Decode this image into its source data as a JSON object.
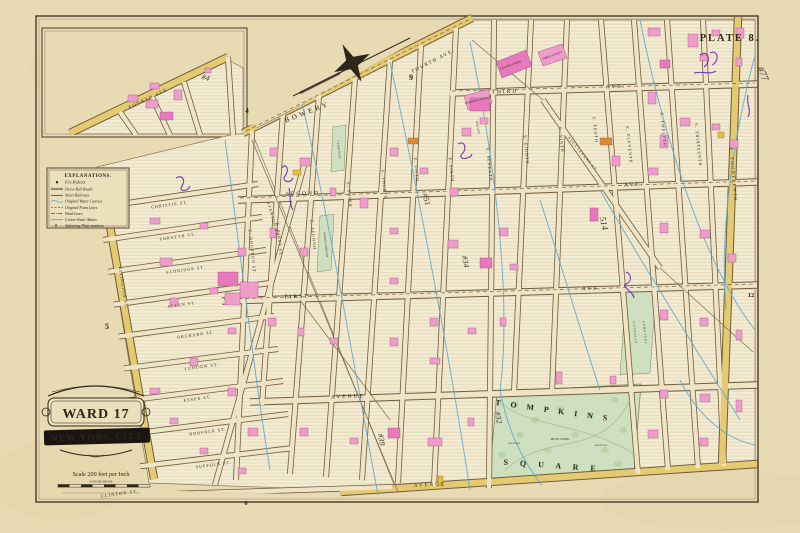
{
  "plate": {
    "title": "PLATE 8.",
    "ward_line1": "WARD 17",
    "ward_line2": "NEW YORK CITY",
    "scale_text": "Scale 200 feet per Inch",
    "scale_ticks": "0      100       200       300       400"
  },
  "explanations": {
    "title": "EXPLANATIONS.",
    "plate_number_symbol": "9",
    "items": [
      "Fire Hydrant",
      "Horse Rail Roads",
      "Street Railways",
      "Original Water Courses",
      "Original Farm Lines",
      "Ward Lines",
      "Croton Water Mains",
      "Adjoining Plate numbers"
    ]
  },
  "colors": {
    "paper": "#e8dab3",
    "cream": "#efe4c5",
    "block": "#f3ebd2",
    "yellow": "#e5ca72",
    "pink": "#f09ccb",
    "deeppink": "#e878bc",
    "bright_yellow": "#e2c235",
    "orange": "#dd8a2e",
    "green": "#cfe0c0",
    "blue": "#5ba6d2",
    "purple": "#6a28b0",
    "ink": "#2f2619",
    "border": "#463828"
  },
  "labels": [
    {
      "n": "street-bowery",
      "t": "BOWERY",
      "x": 308,
      "y": 114,
      "r": -21,
      "s": 7,
      "ls": 3
    },
    {
      "n": "street-fourth-ave",
      "t": "FOURTH AVE.",
      "x": 434,
      "y": 62,
      "r": -27,
      "s": 5,
      "ls": 1.5
    },
    {
      "n": "street-third-ave",
      "t": "THIRD",
      "x": 505,
      "y": 93,
      "r": -2,
      "s": 5.5,
      "ls": 2
    },
    {
      "n": "street-third-ave-2",
      "t": "AVE.",
      "x": 616,
      "y": 88,
      "r": -2,
      "s": 5.5,
      "ls": 2
    },
    {
      "n": "street-second-ave",
      "t": "SECOND",
      "x": 303,
      "y": 195,
      "r": -2,
      "s": 5.5,
      "ls": 2
    },
    {
      "n": "street-second-ave-2",
      "t": "AVE.",
      "x": 634,
      "y": 186,
      "r": -2,
      "s": 5.5,
      "ls": 2
    },
    {
      "n": "street-first-ave",
      "t": "FIRST",
      "x": 297,
      "y": 298,
      "r": -2,
      "s": 5.5,
      "ls": 2
    },
    {
      "n": "street-first-ave-2",
      "t": "AVE.",
      "x": 592,
      "y": 290,
      "r": -2,
      "s": 5.5,
      "ls": 2
    },
    {
      "n": "street-avenue-a",
      "t": "AVENUE",
      "x": 348,
      "y": 398,
      "r": -2,
      "s": 5.5,
      "ls": 2
    },
    {
      "n": "street-avenue-b",
      "t": "AVENUE",
      "x": 430,
      "y": 486,
      "r": -3,
      "s": 5,
      "ls": 2
    },
    {
      "n": "street-clinton",
      "t": "CLINTON ST.",
      "x": 120,
      "y": 495,
      "r": -8,
      "s": 4.5,
      "ls": 1
    },
    {
      "n": "street-christie",
      "t": "CHRISTIE ST.",
      "x": 170,
      "y": 206,
      "r": -8,
      "s": 4.2,
      "ls": 1
    },
    {
      "n": "street-forsyth",
      "t": "FORSYTH ST.",
      "x": 178,
      "y": 238,
      "r": -8,
      "s": 4.2,
      "ls": 1
    },
    {
      "n": "street-eldridge",
      "t": "ELDRIDGE ST.",
      "x": 186,
      "y": 271,
      "r": -8,
      "s": 4.2,
      "ls": 1
    },
    {
      "n": "street-allen",
      "t": "ALLEN ST.",
      "x": 182,
      "y": 306,
      "r": -8,
      "s": 4.2,
      "ls": 1
    },
    {
      "n": "street-orchard",
      "t": "ORCHARD ST.",
      "x": 196,
      "y": 336,
      "r": -8,
      "s": 4.2,
      "ls": 1
    },
    {
      "n": "street-ludlow",
      "t": "LUDLOW ST.",
      "x": 202,
      "y": 368,
      "r": -8,
      "s": 4.2,
      "ls": 1
    },
    {
      "n": "street-essex",
      "t": "ESSEX ST.",
      "x": 198,
      "y": 400,
      "r": -8,
      "s": 4.2,
      "ls": 1
    },
    {
      "n": "street-norfolk",
      "t": "NORFOLK ST.",
      "x": 208,
      "y": 433,
      "r": -8,
      "s": 4.2,
      "ls": 1
    },
    {
      "n": "street-suffolk",
      "t": "SUFFOLK ST.",
      "x": 214,
      "y": 466,
      "r": -8,
      "s": 4.2,
      "ls": 1
    },
    {
      "n": "street-stanton",
      "t": "STANTON ST.",
      "x": 272,
      "y": 220,
      "r": 74,
      "s": 4.2,
      "ls": 1
    },
    {
      "n": "street-rivington",
      "t": "RIVINGTON ST.",
      "x": 122,
      "y": 288,
      "r": 81,
      "s": 4.2,
      "ls": 1
    },
    {
      "n": "street-houston",
      "t": "E. HOUSTON ST.",
      "x": 251,
      "y": 252,
      "r": 84,
      "s": 4.2,
      "ls": 1
    },
    {
      "n": "street-e-first",
      "t": "E. FIRST ST.",
      "x": 278,
      "y": 240,
      "r": 84,
      "s": 4.2,
      "ls": 1
    },
    {
      "n": "street-e-second",
      "t": "E. SECOND",
      "x": 312,
      "y": 235,
      "r": 84,
      "s": 4.2,
      "ls": 1
    },
    {
      "n": "street-e-third",
      "t": "E. THIRD",
      "x": 348,
      "y": 195,
      "r": 84,
      "s": 4.2,
      "ls": 1
    },
    {
      "n": "street-e-fourth",
      "t": "E. FOURTH",
      "x": 383,
      "y": 185,
      "r": 84,
      "s": 4.2,
      "ls": 1
    },
    {
      "n": "street-e-fifth",
      "t": "E. FIFTH",
      "x": 415,
      "y": 170,
      "r": 84,
      "s": 4.2,
      "ls": 1
    },
    {
      "n": "street-e-sixth",
      "t": "E. SIXTH",
      "x": 450,
      "y": 170,
      "r": 84,
      "s": 4.2,
      "ls": 1
    },
    {
      "n": "street-e-seventh",
      "t": "E. SEVENTH",
      "x": 488,
      "y": 165,
      "r": 84,
      "s": 4.2,
      "ls": 1
    },
    {
      "n": "street-e-eighth",
      "t": "E. EIGHTH",
      "x": 525,
      "y": 150,
      "r": 84,
      "s": 4.2,
      "ls": 1
    },
    {
      "n": "street-e-ninth",
      "t": "E. NINTH",
      "x": 560,
      "y": 140,
      "r": 84,
      "s": 4.2,
      "ls": 1
    },
    {
      "n": "street-e-tenth",
      "t": "E. TENTH",
      "x": 594,
      "y": 130,
      "r": 84,
      "s": 4.2,
      "ls": 1
    },
    {
      "n": "street-e-eleventh",
      "t": "E. ELEVENTH",
      "x": 628,
      "y": 145,
      "r": 84,
      "s": 4.2,
      "ls": 1
    },
    {
      "n": "street-e-twelfth",
      "t": "E. TWELFTH",
      "x": 662,
      "y": 130,
      "r": 84,
      "s": 4.2,
      "ls": 1
    },
    {
      "n": "street-e-thirteenth",
      "t": "E. THIRTEENTH",
      "x": 697,
      "y": 145,
      "r": 84,
      "s": 4.2,
      "ls": 1
    },
    {
      "n": "street-e-fourteenth",
      "t": "E. FOURTEENTH",
      "x": 732,
      "y": 175,
      "r": 85,
      "s": 4.6,
      "ls": 1.5
    },
    {
      "n": "street-stuyvesant",
      "t": "STUYVESANT ST.",
      "x": 582,
      "y": 155,
      "r": 50,
      "s": 3.8,
      "ls": 1
    },
    {
      "n": "street-hall-place",
      "t": "HALL PL.",
      "x": 477,
      "y": 128,
      "r": 80,
      "s": 3.2,
      "ls": 0
    },
    {
      "n": "landmark-cooper-union",
      "t": "COOPER UNION",
      "x": 511,
      "y": 66,
      "r": -20,
      "s": 3,
      "ls": 0
    },
    {
      "n": "landmark-bible-society",
      "t": "BIBLE SOCIETY",
      "x": 553,
      "y": 56,
      "r": -20,
      "s": 2.8,
      "ls": 0
    },
    {
      "n": "landmark-tompkins-market",
      "t": "TOMPKINS MARKET",
      "x": 478,
      "y": 101,
      "r": -14,
      "s": 2.8,
      "ls": 0
    },
    {
      "n": "landmark-marble-cemetery-1",
      "t": "CEMETERY",
      "x": 338,
      "y": 150,
      "r": 84,
      "s": 2.8,
      "ls": 0.5
    },
    {
      "n": "landmark-marble-cemetery-2",
      "t": "MARBLE CEMETERY",
      "x": 325,
      "y": 245,
      "r": 84,
      "s": 2.6,
      "ls": 0
    },
    {
      "n": "landmark-catholic-cemetery-1",
      "t": "CATHOLIC",
      "x": 634,
      "y": 333,
      "r": 84,
      "s": 3,
      "ls": 1
    },
    {
      "n": "landmark-catholic-cemetery-2",
      "t": "CEMETERY",
      "x": 644,
      "y": 333,
      "r": 84,
      "s": 3,
      "ls": 1
    },
    {
      "n": "park-tompkins-label",
      "t": "T O M P K I N S",
      "x": 553,
      "y": 413,
      "r": 8,
      "s": 8,
      "ls": 4,
      "f": "b"
    },
    {
      "n": "park-square-label",
      "t": "S Q U A R E",
      "x": 552,
      "y": 468,
      "r": 4,
      "s": 8,
      "ls": 5,
      "f": "b"
    },
    {
      "n": "park-music-stand",
      "t": "MUSIC STAND",
      "x": 560,
      "y": 440,
      "r": 0,
      "s": 2.8
    },
    {
      "n": "park-fountain-1",
      "t": "FOUNTAIN",
      "x": 514,
      "y": 444,
      "r": 0,
      "s": 2.5
    },
    {
      "n": "park-fountain-2",
      "t": "FOUNTAIN",
      "x": 601,
      "y": 446,
      "r": 0,
      "s": 2.5
    },
    {
      "n": "plate-number-9",
      "t": "9",
      "x": 411,
      "y": 80,
      "r": 0,
      "s": 8,
      "f": "b"
    },
    {
      "n": "plate-number-4",
      "t": "4",
      "x": 247,
      "y": 113,
      "r": 0,
      "s": 7,
      "f": "b"
    },
    {
      "n": "plate-number-5",
      "t": "5",
      "x": 107,
      "y": 329,
      "r": 0,
      "s": 8,
      "f": "b"
    },
    {
      "n": "plate-number-12",
      "t": "12",
      "x": 751,
      "y": 297,
      "r": 0,
      "s": 6.5,
      "f": "b"
    },
    {
      "n": "plate-number-6",
      "t": "6",
      "x": 246,
      "y": 505,
      "r": 0,
      "s": 6.5,
      "f": "b"
    },
    {
      "n": "inset-fourth-ave",
      "t": "FOURTH AVE.",
      "x": 150,
      "y": 99,
      "r": -26,
      "s": 4.6,
      "ls": 1.5
    }
  ],
  "annotations": [
    {
      "n": "ink-note-1",
      "t": "#4",
      "x": 205,
      "y": 80,
      "r": 15,
      "s": 8
    },
    {
      "n": "ink-note-2",
      "t": "#77",
      "x": 760,
      "y": 75,
      "r": 65,
      "s": 10
    },
    {
      "n": "ink-note-3",
      "t": "#51",
      "x": 424,
      "y": 200,
      "r": 75,
      "s": 8
    },
    {
      "n": "ink-note-4",
      "t": "514",
      "x": 601,
      "y": 224,
      "r": 78,
      "s": 9
    },
    {
      "n": "ink-note-5",
      "t": "#34",
      "x": 463,
      "y": 262,
      "r": 80,
      "s": 8
    },
    {
      "n": "ink-note-6",
      "t": "#32",
      "x": 496,
      "y": 418,
      "r": 80,
      "s": 8
    },
    {
      "n": "ink-note-7",
      "t": "#39",
      "x": 379,
      "y": 440,
      "r": 80,
      "s": 8
    }
  ]
}
